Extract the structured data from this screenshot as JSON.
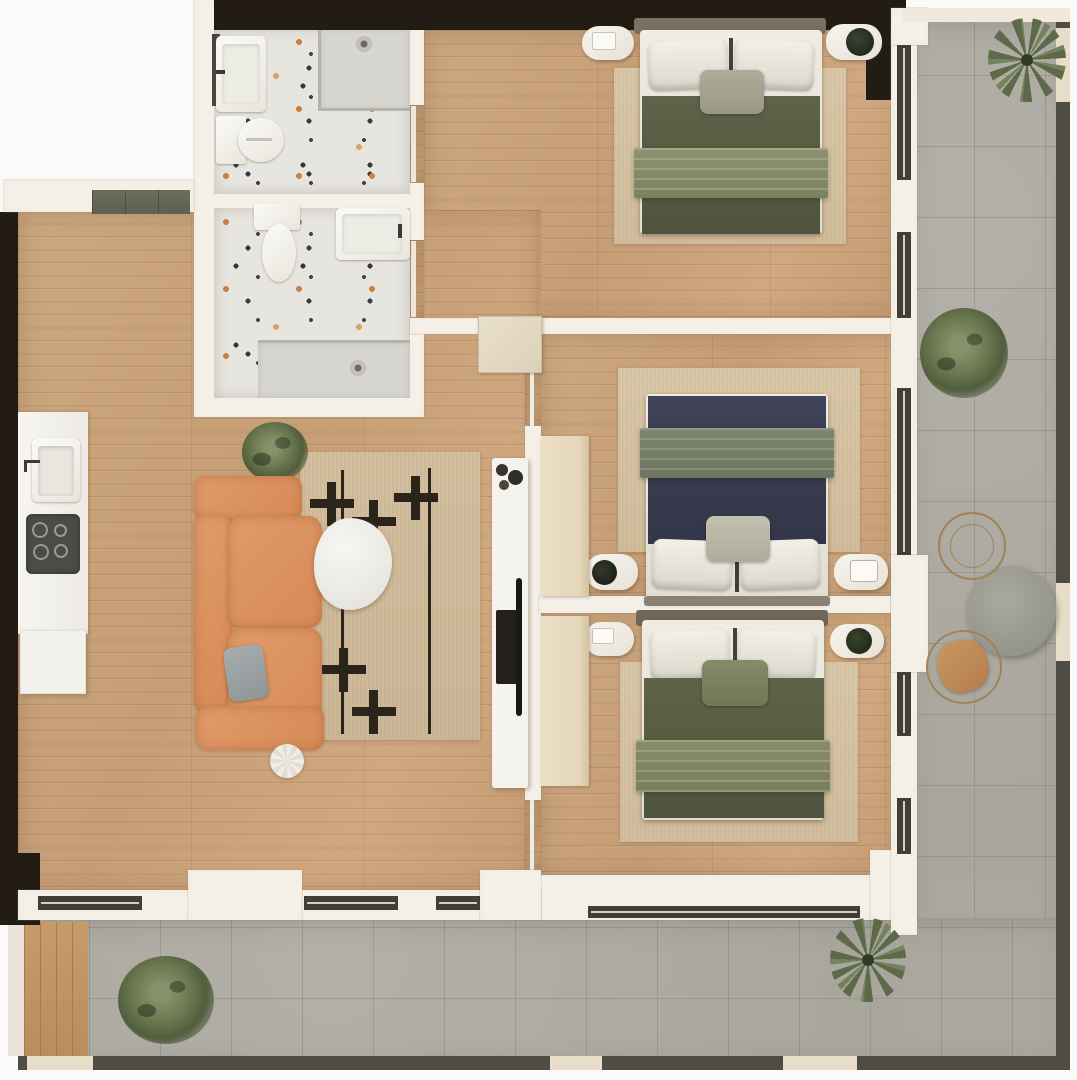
{
  "title": "Apartment floor plan – top-down 3D render",
  "canvas": {
    "width": 1077,
    "height": 1080
  },
  "rooms": [
    {
      "id": "living-kitchen",
      "label": "Living room / Kitchen",
      "floor": "light oak plank",
      "features": [
        "kitchen counter with sink",
        "induction cooktop",
        "base cabinet",
        "terracotta 3-seat sofa",
        "gray throw pillow",
        "round marble coffee table",
        "patterned area rug",
        "white pouf",
        "potted plant",
        "TV wall unit with media console"
      ]
    },
    {
      "id": "bathroom-1",
      "label": "Bathroom 1 (top)",
      "floor": "terrazzo",
      "features": [
        "washbasin",
        "toilet",
        "walk-in shower with drain"
      ]
    },
    {
      "id": "bathroom-2",
      "label": "Bathroom 2 (lower)",
      "floor": "terrazzo",
      "features": [
        "toilet",
        "washbasin",
        "walk-in shower with drain"
      ]
    },
    {
      "id": "bedroom-1",
      "label": "Bedroom 1 (top)",
      "floor": "light oak plank",
      "features": [
        "double bed – olive duvet with sage throw",
        "two nightstands",
        "area rug",
        "plant on nightstand"
      ]
    },
    {
      "id": "bedroom-2",
      "label": "Bedroom 2 (middle)",
      "floor": "light oak plank",
      "features": [
        "double bed – navy duvet with sage throw",
        "two nightstands",
        "wardrobe",
        "area rug"
      ]
    },
    {
      "id": "bedroom-3",
      "label": "Bedroom 3 (bottom)",
      "floor": "light oak plank",
      "features": [
        "double bed – olive duvet with sage throw",
        "two nightstands",
        "wardrobe",
        "area rug"
      ]
    },
    {
      "id": "terrace",
      "label": "L-shaped terrace",
      "floor": "gray stone tile",
      "features": [
        "round outdoor table",
        "two wire chairs (one tan seat)",
        "two palms",
        "two shrubs",
        "wood deck corner",
        "parapet with glass panels"
      ]
    }
  ],
  "entrance": {
    "doormat": "dark olive doormat at top-left entry"
  },
  "palette": {
    "wood": "#c9a37d",
    "wall_light": "#f4f0e8",
    "wall_dark": "#231c14",
    "tile_gray": "#adaba2",
    "terrazzo_base": "#e7e5df",
    "sofa_orange": "#d98e60",
    "duvet_olive": "#575c44",
    "duvet_navy": "#3c3f52",
    "blanket_sage": "#868c6c",
    "pillow_white": "#efece4",
    "rug_beige": "#d5c3a4",
    "rug_pattern_black": "#2b241b",
    "wardrobe_beige": "#e8dcc2",
    "deck_wood": "#c29468",
    "doormat_olive": "#646753",
    "parapet_dark": "#4f4d43",
    "glass_panel": "#e8ddc8",
    "outdoor_table_gray": "#9c9c93",
    "chair_seat_tan": "#c08a58",
    "plant_green": "#5c6a49"
  }
}
